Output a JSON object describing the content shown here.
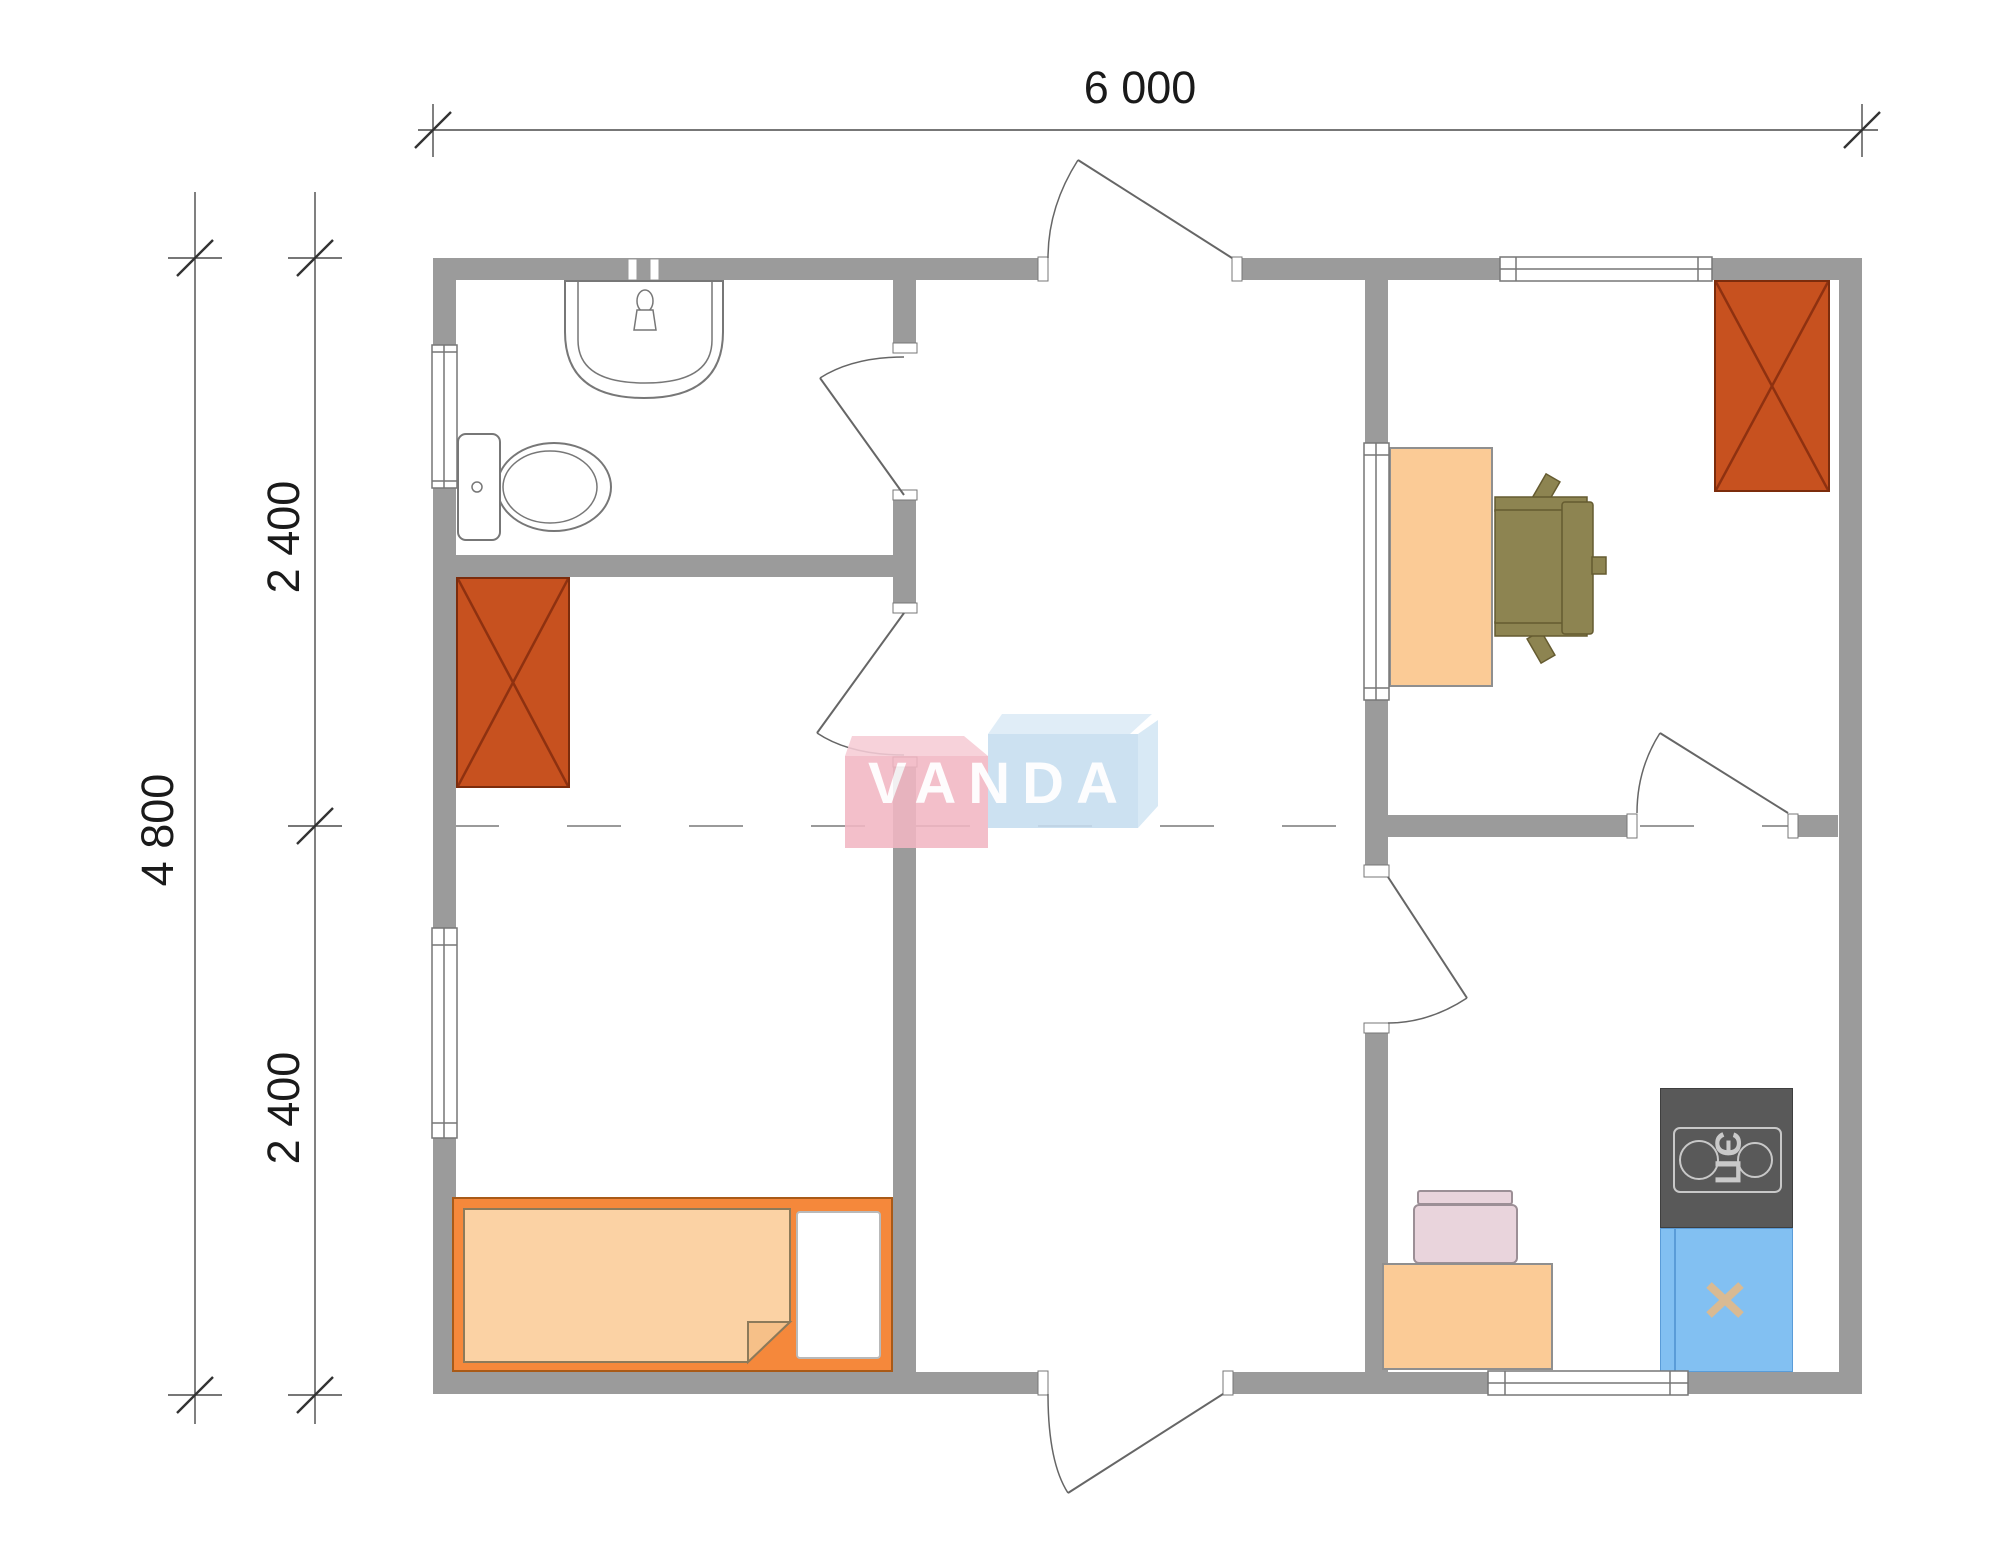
{
  "document": {
    "type": "floor-plan",
    "brand": "VANDA"
  },
  "dimensions": {
    "width_total": "6 000",
    "height_total": "4 800",
    "height_upper": "2 400",
    "height_lower": "2 400"
  },
  "watermark": {
    "text": "VANDA",
    "pink_color": "#f2b7c3",
    "blue_color": "#c6ddf0"
  },
  "kitchen": {
    "stove_label": "ЭП"
  },
  "palette": {
    "wall": "#9b9b9b",
    "wardrobe": "#c7511f",
    "wardrobe_cross": "#8e3110",
    "bed_frame": "#f5883b",
    "bed_blanket": "#fbd2a4",
    "desk": "#fbcb96",
    "office_chair": "#8d8451",
    "kitchen_chair": "#e9d4dc",
    "stove": "#595959",
    "sink_unit": "#82c0f2",
    "sink_cross": "#d9ba93"
  }
}
